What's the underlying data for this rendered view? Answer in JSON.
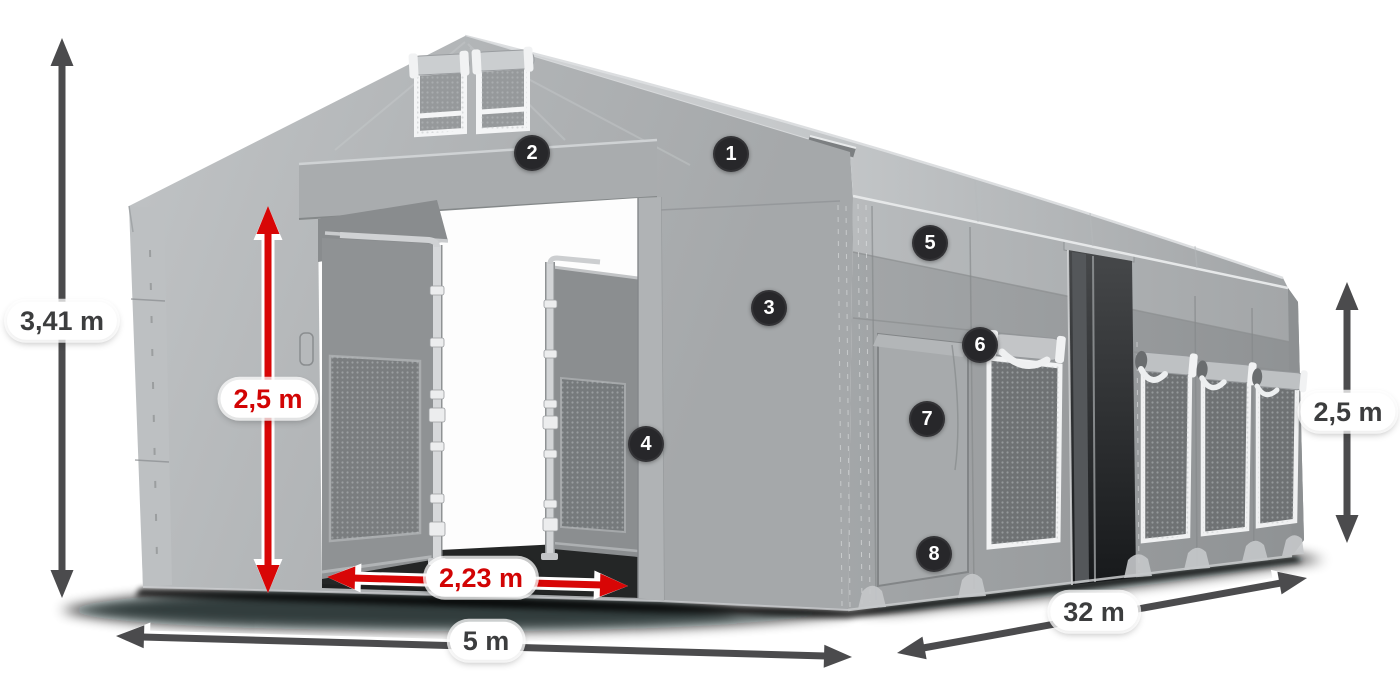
{
  "diagram_title": "Storage tent dimensions diagram",
  "dimensions": {
    "total_height": "3,41 m",
    "entrance_height": "2,5 m",
    "entrance_width": "2,23 m",
    "width": "5 m",
    "length": "32 m",
    "side_height": "2,5 m"
  },
  "markers": [
    "1",
    "2",
    "3",
    "4",
    "5",
    "6",
    "7",
    "8"
  ],
  "colors": {
    "dimension_red": "#d20404",
    "dimension_dark": "#4b4b4d",
    "marker_background": "#27272a",
    "tent_gray": "#a9acae",
    "background": "#ffffff"
  }
}
